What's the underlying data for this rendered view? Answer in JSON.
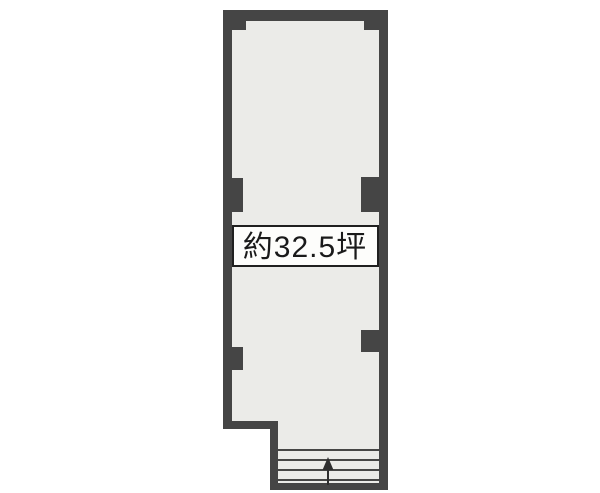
{
  "floorplan": {
    "type": "real-estate-floor-plan",
    "area_label": "約32.5坪",
    "colors": {
      "background": "#ffffff",
      "wall": "#454545",
      "interior": "#ebebe8",
      "label_box_bg": "#fdfdfb",
      "label_box_border": "#1f1f1f",
      "label_text": "#1a1a1a",
      "stair_line": "#2e2e2e"
    },
    "stairs": {
      "direction_icon": "up-arrow",
      "tread_lines": 4
    }
  }
}
